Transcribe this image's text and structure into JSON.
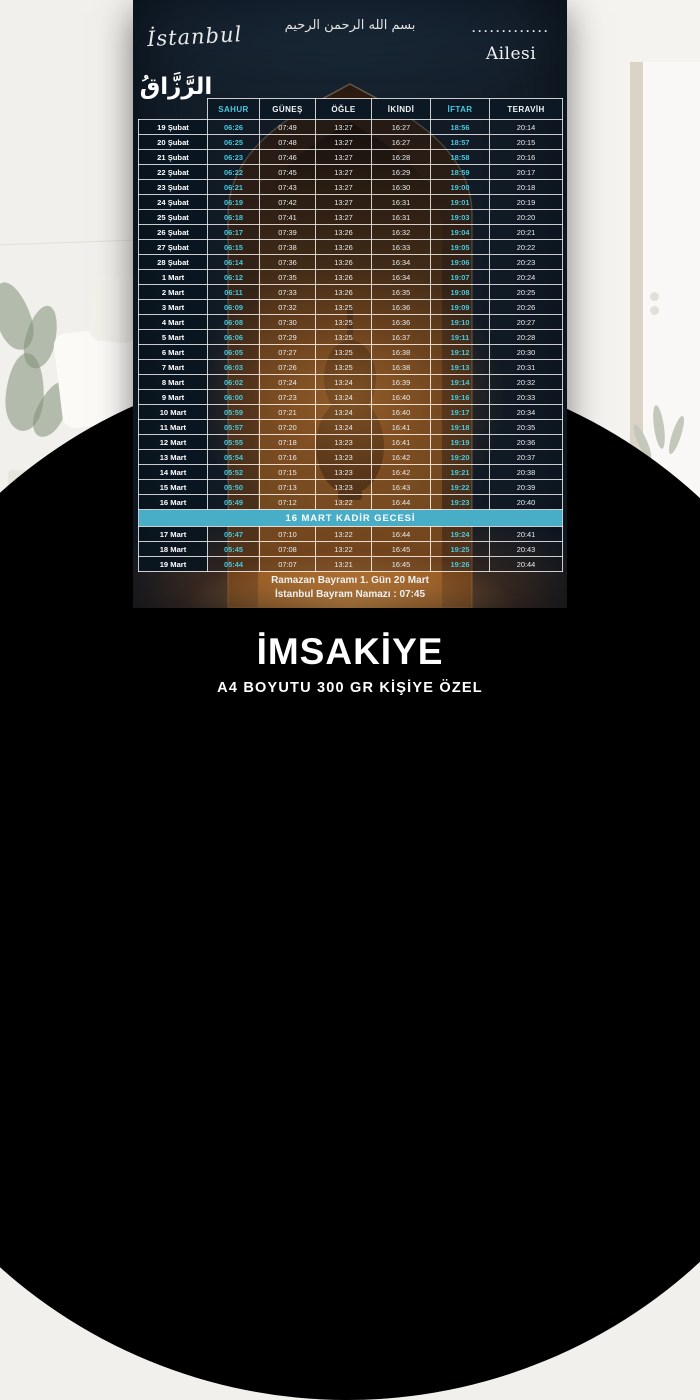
{
  "poster": {
    "city_script": "İstanbul",
    "basmala": "بسم الله الرحمن الرحيم",
    "family_dots": "·············",
    "family_label": "Ailesi",
    "calligraphy_name": "الرَّزَّاقُ",
    "table": {
      "columns": [
        "SAHUR",
        "GÜNEŞ",
        "ÖĞLE",
        "İKİNDİ",
        "İFTAR",
        "TERAVİH"
      ],
      "accent_columns": [
        "SAHUR",
        "İFTAR"
      ],
      "rows": [
        {
          "type": "day",
          "date": "19 Şubat",
          "times": [
            "06:26",
            "07:49",
            "13:27",
            "16:27",
            "18:56",
            "20:14"
          ]
        },
        {
          "type": "day",
          "date": "20 Şubat",
          "times": [
            "06:25",
            "07:48",
            "13:27",
            "16:27",
            "18:57",
            "20:15"
          ]
        },
        {
          "type": "day",
          "date": "21 Şubat",
          "times": [
            "06:23",
            "07:46",
            "13:27",
            "16:28",
            "18:58",
            "20:16"
          ]
        },
        {
          "type": "day",
          "date": "22 Şubat",
          "times": [
            "06:22",
            "07:45",
            "13:27",
            "16:29",
            "18:59",
            "20:17"
          ]
        },
        {
          "type": "day",
          "date": "23 Şubat",
          "times": [
            "06:21",
            "07:43",
            "13:27",
            "16:30",
            "19:00",
            "20:18"
          ]
        },
        {
          "type": "day",
          "date": "24 Şubat",
          "times": [
            "06:19",
            "07:42",
            "13:27",
            "16:31",
            "19:01",
            "20:19"
          ]
        },
        {
          "type": "day",
          "date": "25 Şubat",
          "times": [
            "06:18",
            "07:41",
            "13:27",
            "16:31",
            "19:03",
            "20:20"
          ]
        },
        {
          "type": "day",
          "date": "26 Şubat",
          "times": [
            "06:17",
            "07:39",
            "13:26",
            "16:32",
            "19:04",
            "20:21"
          ]
        },
        {
          "type": "day",
          "date": "27 Şubat",
          "times": [
            "06:15",
            "07:38",
            "13:26",
            "16:33",
            "19:05",
            "20:22"
          ]
        },
        {
          "type": "day",
          "date": "28 Şubat",
          "times": [
            "06:14",
            "07:36",
            "13:26",
            "16:34",
            "19:06",
            "20:23"
          ]
        },
        {
          "type": "day",
          "date": "1 Mart",
          "times": [
            "06:12",
            "07:35",
            "13:26",
            "16:34",
            "19:07",
            "20:24"
          ]
        },
        {
          "type": "day",
          "date": "2 Mart",
          "times": [
            "06:11",
            "07:33",
            "13:26",
            "16:35",
            "19:08",
            "20:25"
          ]
        },
        {
          "type": "day",
          "date": "3 Mart",
          "times": [
            "06:09",
            "07:32",
            "13:25",
            "16:36",
            "19:09",
            "20:26"
          ]
        },
        {
          "type": "day",
          "date": "4 Mart",
          "times": [
            "06:08",
            "07:30",
            "13:25",
            "16:36",
            "19:10",
            "20:27"
          ]
        },
        {
          "type": "day",
          "date": "5 Mart",
          "times": [
            "06:06",
            "07:29",
            "13:25",
            "16:37",
            "19:11",
            "20:28"
          ]
        },
        {
          "type": "day",
          "date": "6 Mart",
          "times": [
            "06:05",
            "07:27",
            "13:25",
            "16:38",
            "19:12",
            "20:30"
          ]
        },
        {
          "type": "day",
          "date": "7 Mart",
          "times": [
            "06:03",
            "07:26",
            "13:25",
            "16:38",
            "19:13",
            "20:31"
          ]
        },
        {
          "type": "day",
          "date": "8 Mart",
          "times": [
            "06:02",
            "07:24",
            "13:24",
            "16:39",
            "19:14",
            "20:32"
          ]
        },
        {
          "type": "day",
          "date": "9 Mart",
          "times": [
            "06:00",
            "07:23",
            "13:24",
            "16:40",
            "19:16",
            "20:33"
          ]
        },
        {
          "type": "day",
          "date": "10 Mart",
          "times": [
            "05:59",
            "07:21",
            "13:24",
            "16:40",
            "19:17",
            "20:34"
          ]
        },
        {
          "type": "day",
          "date": "11 Mart",
          "times": [
            "05:57",
            "07:20",
            "13:24",
            "16:41",
            "19:18",
            "20:35"
          ]
        },
        {
          "type": "day",
          "date": "12 Mart",
          "times": [
            "05:55",
            "07:18",
            "13:23",
            "16:41",
            "19:19",
            "20:36"
          ]
        },
        {
          "type": "day",
          "date": "13 Mart",
          "times": [
            "05:54",
            "07:16",
            "13:23",
            "16:42",
            "19:20",
            "20:37"
          ]
        },
        {
          "type": "day",
          "date": "14 Mart",
          "times": [
            "05:52",
            "07:15",
            "13:23",
            "16:42",
            "19:21",
            "20:38"
          ]
        },
        {
          "type": "day",
          "date": "15 Mart",
          "times": [
            "05:50",
            "07:13",
            "13:23",
            "16:43",
            "19:22",
            "20:39"
          ]
        },
        {
          "type": "day",
          "date": "16 Mart",
          "times": [
            "05:49",
            "07:12",
            "13:22",
            "16:44",
            "19:23",
            "20:40"
          ]
        },
        {
          "type": "banner",
          "label": "16 MART KADİR GECESİ"
        },
        {
          "type": "day",
          "date": "17 Mart",
          "times": [
            "05:47",
            "07:10",
            "13:22",
            "16:44",
            "19:24",
            "20:41"
          ]
        },
        {
          "type": "day",
          "date": "18 Mart",
          "times": [
            "05:45",
            "07:08",
            "13:22",
            "16:45",
            "19:25",
            "20:43"
          ]
        },
        {
          "type": "day",
          "date": "19 Mart",
          "times": [
            "05:44",
            "07:07",
            "13:21",
            "16:45",
            "19:26",
            "20:44"
          ]
        }
      ]
    },
    "footer": {
      "line1": "Ramazan Bayramı 1. Gün 20 Mart",
      "line2": "İstanbul Bayram Namazı : 07:45"
    }
  },
  "caption": {
    "title": "İMSAKİYE",
    "subtitle": "A4 BOYUTU 300 GR KİŞİYE ÖZEL"
  },
  "colors": {
    "accent_cyan": "#46c8dc",
    "banner_blue": "#48aec8",
    "poster_bg": "#131e29",
    "circle_black": "#000000",
    "caption_text": "#ffffff"
  }
}
